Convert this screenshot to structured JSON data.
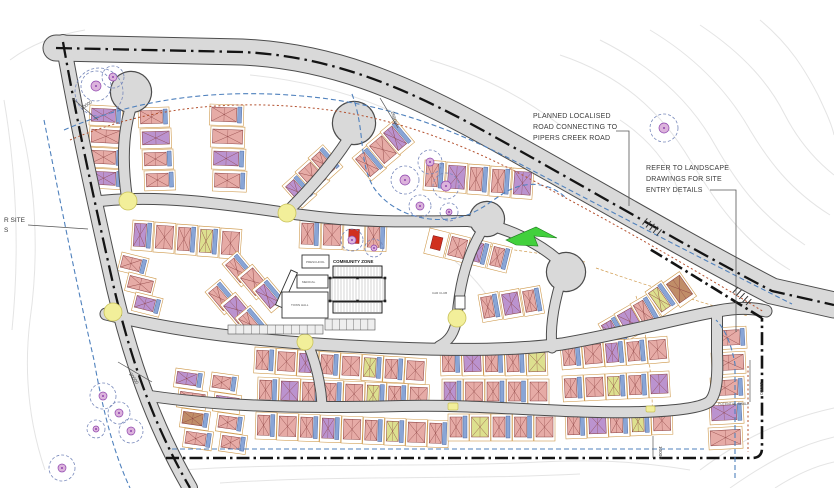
{
  "annotations": {
    "planned_road": {
      "lines": [
        "PLANNED LOCALISED",
        "ROAD CONNECTING TO",
        "PIPERS CREEK ROAD"
      ]
    },
    "landscape": {
      "lines": [
        "REFER TO LANDSCAPE",
        "DRAWINGS FOR SITE",
        "ENTRY DETAILS"
      ]
    },
    "left_edge": {
      "lines": [
        "R SITE",
        "S"
      ]
    },
    "community_zone_label": "COMMUNITY ZONE",
    "potential_swale_label": "POTENTIAL SWALE",
    "car_club_label": "CAR CLUB",
    "building_labels": [
      "PRESCHOOL",
      "MEDICAL",
      "TOWN HALL"
    ]
  },
  "dimensions": [
    {
      "text": "20000",
      "x": 82,
      "y": 110,
      "rot": -35
    },
    {
      "text": "26800",
      "x": 391,
      "y": 112,
      "rot": 75
    },
    {
      "text": "20000",
      "x": 129,
      "y": 374,
      "rot": 55
    },
    {
      "text": "10000",
      "x": 760,
      "y": 382,
      "rot": 90
    },
    {
      "text": "10000",
      "x": 659,
      "y": 446,
      "rot": 90
    }
  ],
  "colors": {
    "road_fill": "#d9d9d9",
    "road_casing": "#4c4c4c",
    "boundary": "#141414",
    "blue_dash": "#4f81bd",
    "red_dotted": "#b3502e",
    "tan": "#cf9a4d",
    "yellow": "#f2ef9a",
    "yellow_edge": "#c9c25a",
    "contour": "#e4e4e4",
    "tree_ring": "#7788bb",
    "tree_fill": "#dcb3dc",
    "tree_edge": "#8e44ad",
    "green": "#42d03c",
    "green_edge": "#1d7a1d",
    "house_stroke": "#8a4040",
    "slab_fill": "#89a5d6",
    "slab_edge": "#3d5a96",
    "palette": {
      "p": "#e6aba6",
      "v": "#bb93cf",
      "y": "#dde08f",
      "b": "#c08d68",
      "r": "#d03020"
    }
  },
  "geometry": {
    "contours": [
      "M 560,55 C 620,75 660,110 690,160 C 715,200 740,240 790,270",
      "M 600,40 C 650,65 690,100 715,145 C 738,185 760,215 805,245",
      "M 650,30 C 700,60 730,95 750,130 C 768,160 790,190 830,215",
      "M 700,25 C 745,55 770,85 785,115 C 798,140 815,160 834,175",
      "M 760,20 C 790,45 805,70 818,95 C 826,112 832,125 834,135",
      "M 620,120 C 650,140 670,165 680,195",
      "M 700,470 C 740,440 780,420 834,408",
      "M 730,488 C 770,460 800,445 834,437",
      "M 775,488 C 800,472 820,465 834,462",
      "M 180,470 C 300,462 420,468 540,462 C 600,459 640,462 690,470",
      "M 220,483 C 340,475 460,480 580,474",
      "M 20,120 C 35,180 40,250 30,320 C 24,370 28,420 45,470",
      "M 4,100 C 16,170 20,250 12,330",
      "M 430,60 C 480,75 520,95 560,125",
      "M 250,75 C 300,80 350,92 400,115",
      "M 440,250 C 470,270 490,295 500,320",
      "M 10,60 C 30,45 55,35 85,30"
    ],
    "tan_dash": [
      "M 596,268 C 648,286 700,302 748,316",
      "M 636,296 C 648,336 654,386 652,434",
      "M 455,240 C 500,250 545,252 585,262"
    ],
    "lots": [
      {
        "x": 90,
        "y": 105,
        "w": 33,
        "h": 20,
        "dx": 0,
        "dy": 21,
        "n": 4,
        "rot": 3,
        "c": "vppv"
      },
      {
        "x": 138,
        "y": 108,
        "w": 31,
        "h": 20,
        "dx": 2,
        "dy": 21,
        "n": 4,
        "rot": -2,
        "c": "pvpp"
      },
      {
        "x": 210,
        "y": 104,
        "w": 34,
        "h": 21,
        "dx": 1,
        "dy": 22,
        "n": 4,
        "rot": 2,
        "c": "ppvp"
      },
      {
        "x": 282,
        "y": 186,
        "w": 20,
        "h": 30,
        "dx": 13,
        "dy": -14,
        "n": 3,
        "rot": -42,
        "c": "vpp"
      },
      {
        "x": 352,
        "y": 158,
        "w": 20,
        "h": 30,
        "dx": 14,
        "dy": -13,
        "n": 3,
        "rot": -40,
        "c": "ppv"
      },
      {
        "x": 425,
        "y": 160,
        "w": 21,
        "h": 30,
        "dx": 22,
        "dy": 2,
        "n": 5,
        "rot": 4,
        "c": "pvppv"
      },
      {
        "x": 133,
        "y": 220,
        "w": 21,
        "h": 30,
        "dx": 22,
        "dy": 2,
        "n": 5,
        "rot": 4,
        "c": "vppyp"
      },
      {
        "x": 300,
        "y": 220,
        "w": 21,
        "h": 28,
        "dx": 22,
        "dy": 1,
        "n": 4,
        "rot": 2,
        "c": "pprp"
      },
      {
        "x": 430,
        "y": 228,
        "w": 20,
        "h": 26,
        "dx": 21,
        "dy": 5,
        "n": 4,
        "rot": 14,
        "c": "rpvp"
      },
      {
        "x": 478,
        "y": 295,
        "w": 20,
        "h": 28,
        "dx": 21,
        "dy": -3,
        "n": 3,
        "rot": -10,
        "c": "pvp"
      },
      {
        "x": 598,
        "y": 324,
        "w": 20,
        "h": 30,
        "dx": 16,
        "dy": -10,
        "n": 3,
        "rot": -30,
        "c": "vvp"
      },
      {
        "x": 122,
        "y": 252,
        "w": 28,
        "h": 19,
        "dx": 7,
        "dy": 20,
        "n": 3,
        "rot": 14,
        "c": "ppv"
      },
      {
        "x": 222,
        "y": 264,
        "w": 20,
        "h": 30,
        "dx": 15,
        "dy": 13,
        "n": 3,
        "rot": -40,
        "c": "ppv"
      },
      {
        "x": 205,
        "y": 292,
        "w": 20,
        "h": 30,
        "dx": 15,
        "dy": 13,
        "n": 3,
        "rot": -40,
        "c": "pvp"
      },
      {
        "x": 255,
        "y": 347,
        "w": 21,
        "h": 26,
        "dx": 21.5,
        "dy": 1.5,
        "n": 8,
        "rot": 3,
        "c": "ppvppypp"
      },
      {
        "x": 440,
        "y": 350,
        "w": 21,
        "h": 26,
        "dx": 21.5,
        "dy": 0,
        "n": 5,
        "rot": -2,
        "c": "pvppy"
      },
      {
        "x": 560,
        "y": 344,
        "w": 21,
        "h": 26,
        "dx": 21.5,
        "dy": -1.5,
        "n": 5,
        "rot": -5,
        "c": "ppvpp"
      },
      {
        "x": 258,
        "y": 377,
        "w": 21,
        "h": 26,
        "dx": 21.5,
        "dy": 1,
        "n": 8,
        "rot": 2,
        "c": "pvpppypp"
      },
      {
        "x": 442,
        "y": 379,
        "w": 21,
        "h": 26,
        "dx": 21.5,
        "dy": 0,
        "n": 5,
        "rot": 0,
        "c": "vpppp"
      },
      {
        "x": 562,
        "y": 376,
        "w": 21,
        "h": 26,
        "dx": 21.5,
        "dy": -1,
        "n": 5,
        "rot": -3,
        "c": "ppypv"
      },
      {
        "x": 256,
        "y": 412,
        "w": 21,
        "h": 27,
        "dx": 21.5,
        "dy": 1,
        "n": 9,
        "rot": 2,
        "c": "pppvppypp"
      },
      {
        "x": 448,
        "y": 414,
        "w": 21,
        "h": 27,
        "dx": 21.5,
        "dy": 0,
        "n": 5,
        "rot": 0,
        "c": "pyppp"
      },
      {
        "x": 565,
        "y": 412,
        "w": 21,
        "h": 27,
        "dx": 21.5,
        "dy": -1,
        "n": 5,
        "rot": -2,
        "c": "pvpyp"
      },
      {
        "x": 176,
        "y": 368,
        "w": 29,
        "h": 19,
        "dx": 3,
        "dy": 20,
        "n": 4,
        "rot": 8,
        "c": "vpbp"
      },
      {
        "x": 212,
        "y": 372,
        "w": 27,
        "h": 19,
        "dx": 3,
        "dy": 20,
        "n": 4,
        "rot": 8,
        "c": "pvpp"
      },
      {
        "x": 712,
        "y": 328,
        "w": 34,
        "h": 22,
        "dx": -1,
        "dy": 25,
        "n": 5,
        "rot": -3,
        "c": "pppvp"
      },
      {
        "x": 645,
        "y": 292,
        "w": 20,
        "h": 30,
        "dx": 18,
        "dy": -9,
        "n": 2,
        "rot": -35,
        "c": "yb"
      }
    ],
    "roads": [
      {
        "d": "M 56,48 L 242,52 C 330,56 402,86 484,131 C 570,178 676,241 772,291 L 834,305",
        "w": 25,
        "center": true
      },
      {
        "d": "M 63,42 C 78,128 96,208 114,288 C 130,356 152,422 190,488",
        "w": 14,
        "center": true
      },
      {
        "d": "M 100,201 C 168,194 236,206 302,215 C 368,224 426,221 468,221",
        "w": 10
      },
      {
        "d": "M 480,234 C 464,262 459,292 457,317 C 455,333 449,341 439,346",
        "w": 9
      },
      {
        "d": "M 127,198 C 122,164 123,134 130,110",
        "w": 10
      },
      {
        "d": "M 289,210 C 307,192 330,167 347,141",
        "w": 10
      },
      {
        "d": "M 468,221 C 510,226 544,247 560,262",
        "w": 10
      },
      {
        "d": "M 560,284 C 553,308 550,330 552,348",
        "w": 9
      },
      {
        "d": "M 106,314 C 182,333 262,341 332,345 C 420,350 504,352 562,344 C 622,334 682,317 718,311 C 738,307 754,308 766,311",
        "w": 11
      },
      {
        "d": "M 150,396 C 232,408 322,408 402,406 C 482,404 564,414 642,412 C 674,411 700,408 709,402 C 717,395 718,376 717,352 L 717,316",
        "w": 10
      },
      {
        "d": "M 308,344 C 317,366 321,386 322,405",
        "w": 9
      }
    ],
    "culdesacs": [
      {
        "x": 131,
        "y": 92,
        "r": 20
      },
      {
        "x": 354,
        "y": 123,
        "r": 21
      },
      {
        "x": 487,
        "y": 219,
        "r": 17
      },
      {
        "x": 566,
        "y": 272,
        "r": 19
      }
    ],
    "boundary": [
      "M 166,458 L 752,458 Q 762,458 762,448 L 762,318",
      "M 762,318 C 726,296 688,272 648,248"
    ],
    "blue_dash": [
      "M 64,130 C 140,97 222,89 302,96 C 384,103 452,128 522,165 C 604,208 700,258 792,304",
      "M 352,94 C 366,132 358,162 374,188 C 392,214 430,226 464,216 C 486,209 498,194 514,188 C 534,180 554,186 566,198",
      "M 172,449 L 704,449",
      "M 735,478 L 735,364 C 731,342 724,328 716,320",
      "M 44,120 C 60,200 76,282 94,360 C 104,418 116,458 130,488"
    ],
    "red_dotted": [
      "M 70,140 C 150,106 232,100 312,108 C 392,116 462,143 532,180 C 612,222 692,268 764,312",
      "M 748,366 L 748,452"
    ],
    "trees": [
      {
        "x": 96,
        "y": 86,
        "r": 15,
        "ir": 5
      },
      {
        "x": 113,
        "y": 77,
        "r": 11,
        "ir": 4
      },
      {
        "x": 99,
        "y": 92,
        "r": 24,
        "ir": 0
      },
      {
        "x": 664,
        "y": 128,
        "r": 14,
        "ir": 5
      },
      {
        "x": 405,
        "y": 180,
        "r": 14,
        "ir": 5
      },
      {
        "x": 430,
        "y": 162,
        "r": 12,
        "ir": 4
      },
      {
        "x": 446,
        "y": 186,
        "r": 13,
        "ir": 5
      },
      {
        "x": 420,
        "y": 206,
        "r": 11,
        "ir": 4
      },
      {
        "x": 449,
        "y": 212,
        "r": 9,
        "ir": 3
      },
      {
        "x": 352,
        "y": 240,
        "r": 11,
        "ir": 4
      },
      {
        "x": 374,
        "y": 248,
        "r": 9,
        "ir": 3
      },
      {
        "x": 103,
        "y": 396,
        "r": 13,
        "ir": 4
      },
      {
        "x": 119,
        "y": 413,
        "r": 11,
        "ir": 4
      },
      {
        "x": 131,
        "y": 431,
        "r": 12,
        "ir": 4
      },
      {
        "x": 96,
        "y": 429,
        "r": 9,
        "ir": 3
      },
      {
        "x": 62,
        "y": 468,
        "r": 13,
        "ir": 4
      }
    ],
    "yellow_circles": [
      {
        "x": 113,
        "y": 312,
        "r": 9
      },
      {
        "x": 128,
        "y": 201,
        "r": 9
      },
      {
        "x": 287,
        "y": 213,
        "r": 9
      },
      {
        "x": 457,
        "y": 318,
        "r": 9
      },
      {
        "x": 305,
        "y": 342,
        "r": 8
      }
    ],
    "yellow_cushions": [
      {
        "x": 448,
        "y": 403,
        "w": 10,
        "h": 7
      },
      {
        "x": 646,
        "y": 406,
        "w": 9,
        "h": 6
      }
    ],
    "community": {
      "diag": {
        "x": 291,
        "y": 270,
        "w": 7,
        "h": 38,
        "rot": 24
      },
      "b1": {
        "x": 302,
        "y": 255,
        "w": 27,
        "h": 13
      },
      "b2": {
        "x": 297,
        "y": 275,
        "w": 31,
        "h": 13
      },
      "b3": {
        "x": 282,
        "y": 292,
        "w": 46,
        "h": 26
      },
      "cc_top": {
        "x": 333,
        "y": 266,
        "w": 49,
        "h": 11
      },
      "cc_main": {
        "x": 330,
        "y": 278,
        "w": 55,
        "h": 23
      },
      "cc_bot": {
        "x": 333,
        "y": 302,
        "w": 49,
        "h": 11
      },
      "club": {
        "x": 455,
        "y": 296,
        "w": 10,
        "h": 13
      },
      "parking": [
        {
          "x": 228,
          "y": 325,
          "w": 95,
          "h": 9,
          "ticks": 12
        },
        {
          "x": 325,
          "y": 319,
          "w": 50,
          "h": 11,
          "ticks": 7
        }
      ]
    },
    "green_arrow": "506,240 536,227 557,238 534,236 538,246 516,245",
    "tick_groups": [
      {
        "x": 652,
        "y": 227,
        "ang": 38
      },
      {
        "x": 742,
        "y": 296,
        "ang": 42
      }
    ],
    "leaders": [
      "616,131 629,131 629,206",
      "710,190 736,190 736,332",
      "28,225 88,229"
    ],
    "dim_lines": [
      {
        "x1": 750,
        "y1": 360,
        "x2": 750,
        "y2": 402
      },
      {
        "x1": 118,
        "y1": 362,
        "x2": 152,
        "y2": 382
      },
      {
        "x1": 72,
        "y1": 98,
        "x2": 98,
        "y2": 120
      },
      {
        "x1": 380,
        "y1": 98,
        "x2": 398,
        "y2": 128
      },
      {
        "x1": 653,
        "y1": 436,
        "x2": 653,
        "y2": 458
      }
    ]
  }
}
